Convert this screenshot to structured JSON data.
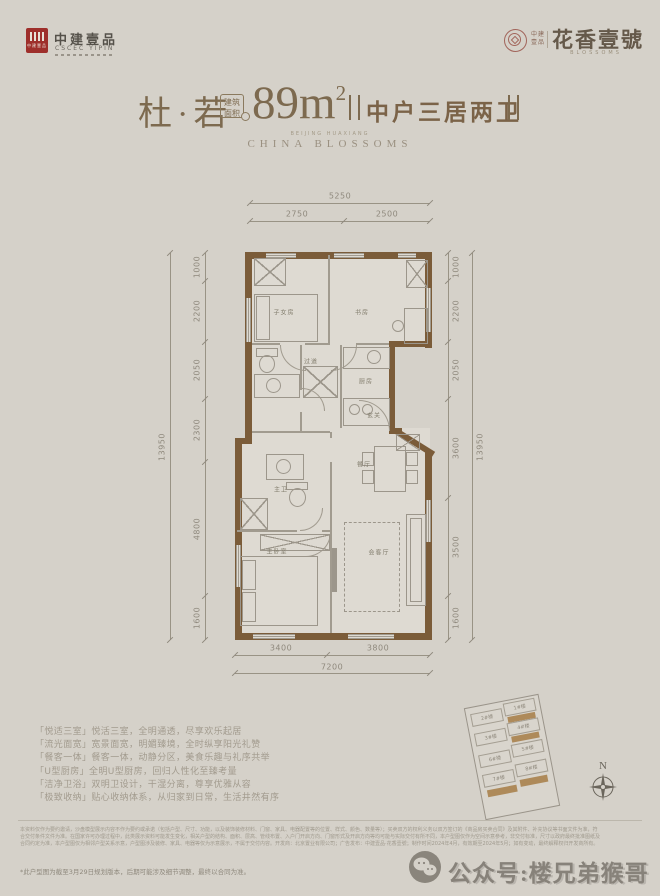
{
  "colors": {
    "brand_red": "#9e2f2b",
    "wall_brown": "#7b5c39",
    "highlight_gold": "#a9824e",
    "title_brown": "#7d6a4f"
  },
  "header": {
    "logo_left": {
      "mark": "中建壹品",
      "name": "中建壹品",
      "sub": "CSCEC YIPIN"
    },
    "logo_right": {
      "small1": "中建",
      "small2": "壹品",
      "name": "花香壹號",
      "sub": "BLOSSOMS"
    }
  },
  "title": {
    "name": "杜·若",
    "badge1": "建筑",
    "badge2": "面积",
    "area": "89m",
    "area_sup": "2",
    "tagline": "中户三居两卫",
    "sub_small": "BEIJING HUAXIANG",
    "sub_en": "CHINA BLOSSOMS"
  },
  "plan": {
    "rooms": [
      {
        "id": "kids-room",
        "label": "子女房"
      },
      {
        "id": "study",
        "label": "书房"
      },
      {
        "id": "corridor",
        "label": "过道"
      },
      {
        "id": "kitchen",
        "label": "厨房"
      },
      {
        "id": "entry",
        "label": "玄关"
      },
      {
        "id": "master-bath",
        "label": "主卫"
      },
      {
        "id": "master-bedroom",
        "label": "主卧室"
      },
      {
        "id": "dining",
        "label": "餐厅"
      },
      {
        "id": "living",
        "label": "会客厅"
      }
    ],
    "dims": {
      "top_total": "5250",
      "top_segs": [
        "2750",
        "2500"
      ],
      "left_total": "13950",
      "left_segs": [
        "1000",
        "2200",
        "2050",
        "2300",
        "4800",
        "1600"
      ],
      "right_total": "13950",
      "right_segs": [
        "1000",
        "2200",
        "2050",
        "3600",
        "3500",
        "1600"
      ],
      "bottom_segs": [
        "3400",
        "3800"
      ],
      "bottom_total": "7200"
    }
  },
  "features": [
    "「悦适三室」悦活三室，全明通透，尽享欢乐起居",
    "「流光面宽」宽景面宽，明媚臻境，全时纵享阳光礼赞",
    "「餐客一体」餐客一体，动静分区，美食乐趣与礼序共举",
    "「U型厨房」全明U型厨房，回归人性化至臻考量",
    "「洁净卫浴」双明卫设计，干湿分离，尊享优雅从容",
    "「极致收纳」贴心收纳体系，从归家到日常，生活井然有序"
  ],
  "siteplan": {
    "buildings": [
      "2#楼",
      "1#楼",
      "3#楼",
      "4#楼",
      "6#楼",
      "5#楼",
      "7#楼",
      "8#楼"
    ],
    "compass_n": "N"
  },
  "footer": {
    "disclaimer": [
      "本资料仅作为要约邀请，沙盘模型展示内容不作为要约或承诺（包括户型、尺寸、功能，以及装饰装修材料、门窗、家具、电器配置等的位置、样式、颜色、数量等）；买卖双方的权利义务以双方签订的《商品房买卖合同》及其附件、补充协议等书面文件为准，符",
      "合交付条件文件为准。在国家许可办理过程中，此类展示资料可能发生变化，相关户型的结构、面积、层高、管线布置、入户门开启方向、门窗形式及开启方向等均可能与实际交付有所不同，本户型图仅作为空间示意参考，非交付标准，尺寸以政府最终批准图纸及",
      "合同约定为准，本户型图仅为相邻户型关系示意，户型图涉及装修、家具、电器等仅为示意展示，不属于交付内容。开发商：北京置业有限公司；广告发布：中建壹品·花香壹號；制作时间2024年4月，有效期至2024年5月；如有变动，最终解释权归开发商所有。"
    ],
    "note": "*此户型图为截至3月29日规划版本，后期可能涉及细节调整，最终以合同为准。",
    "watermark": "公众号:楼兄弟猴哥"
  }
}
